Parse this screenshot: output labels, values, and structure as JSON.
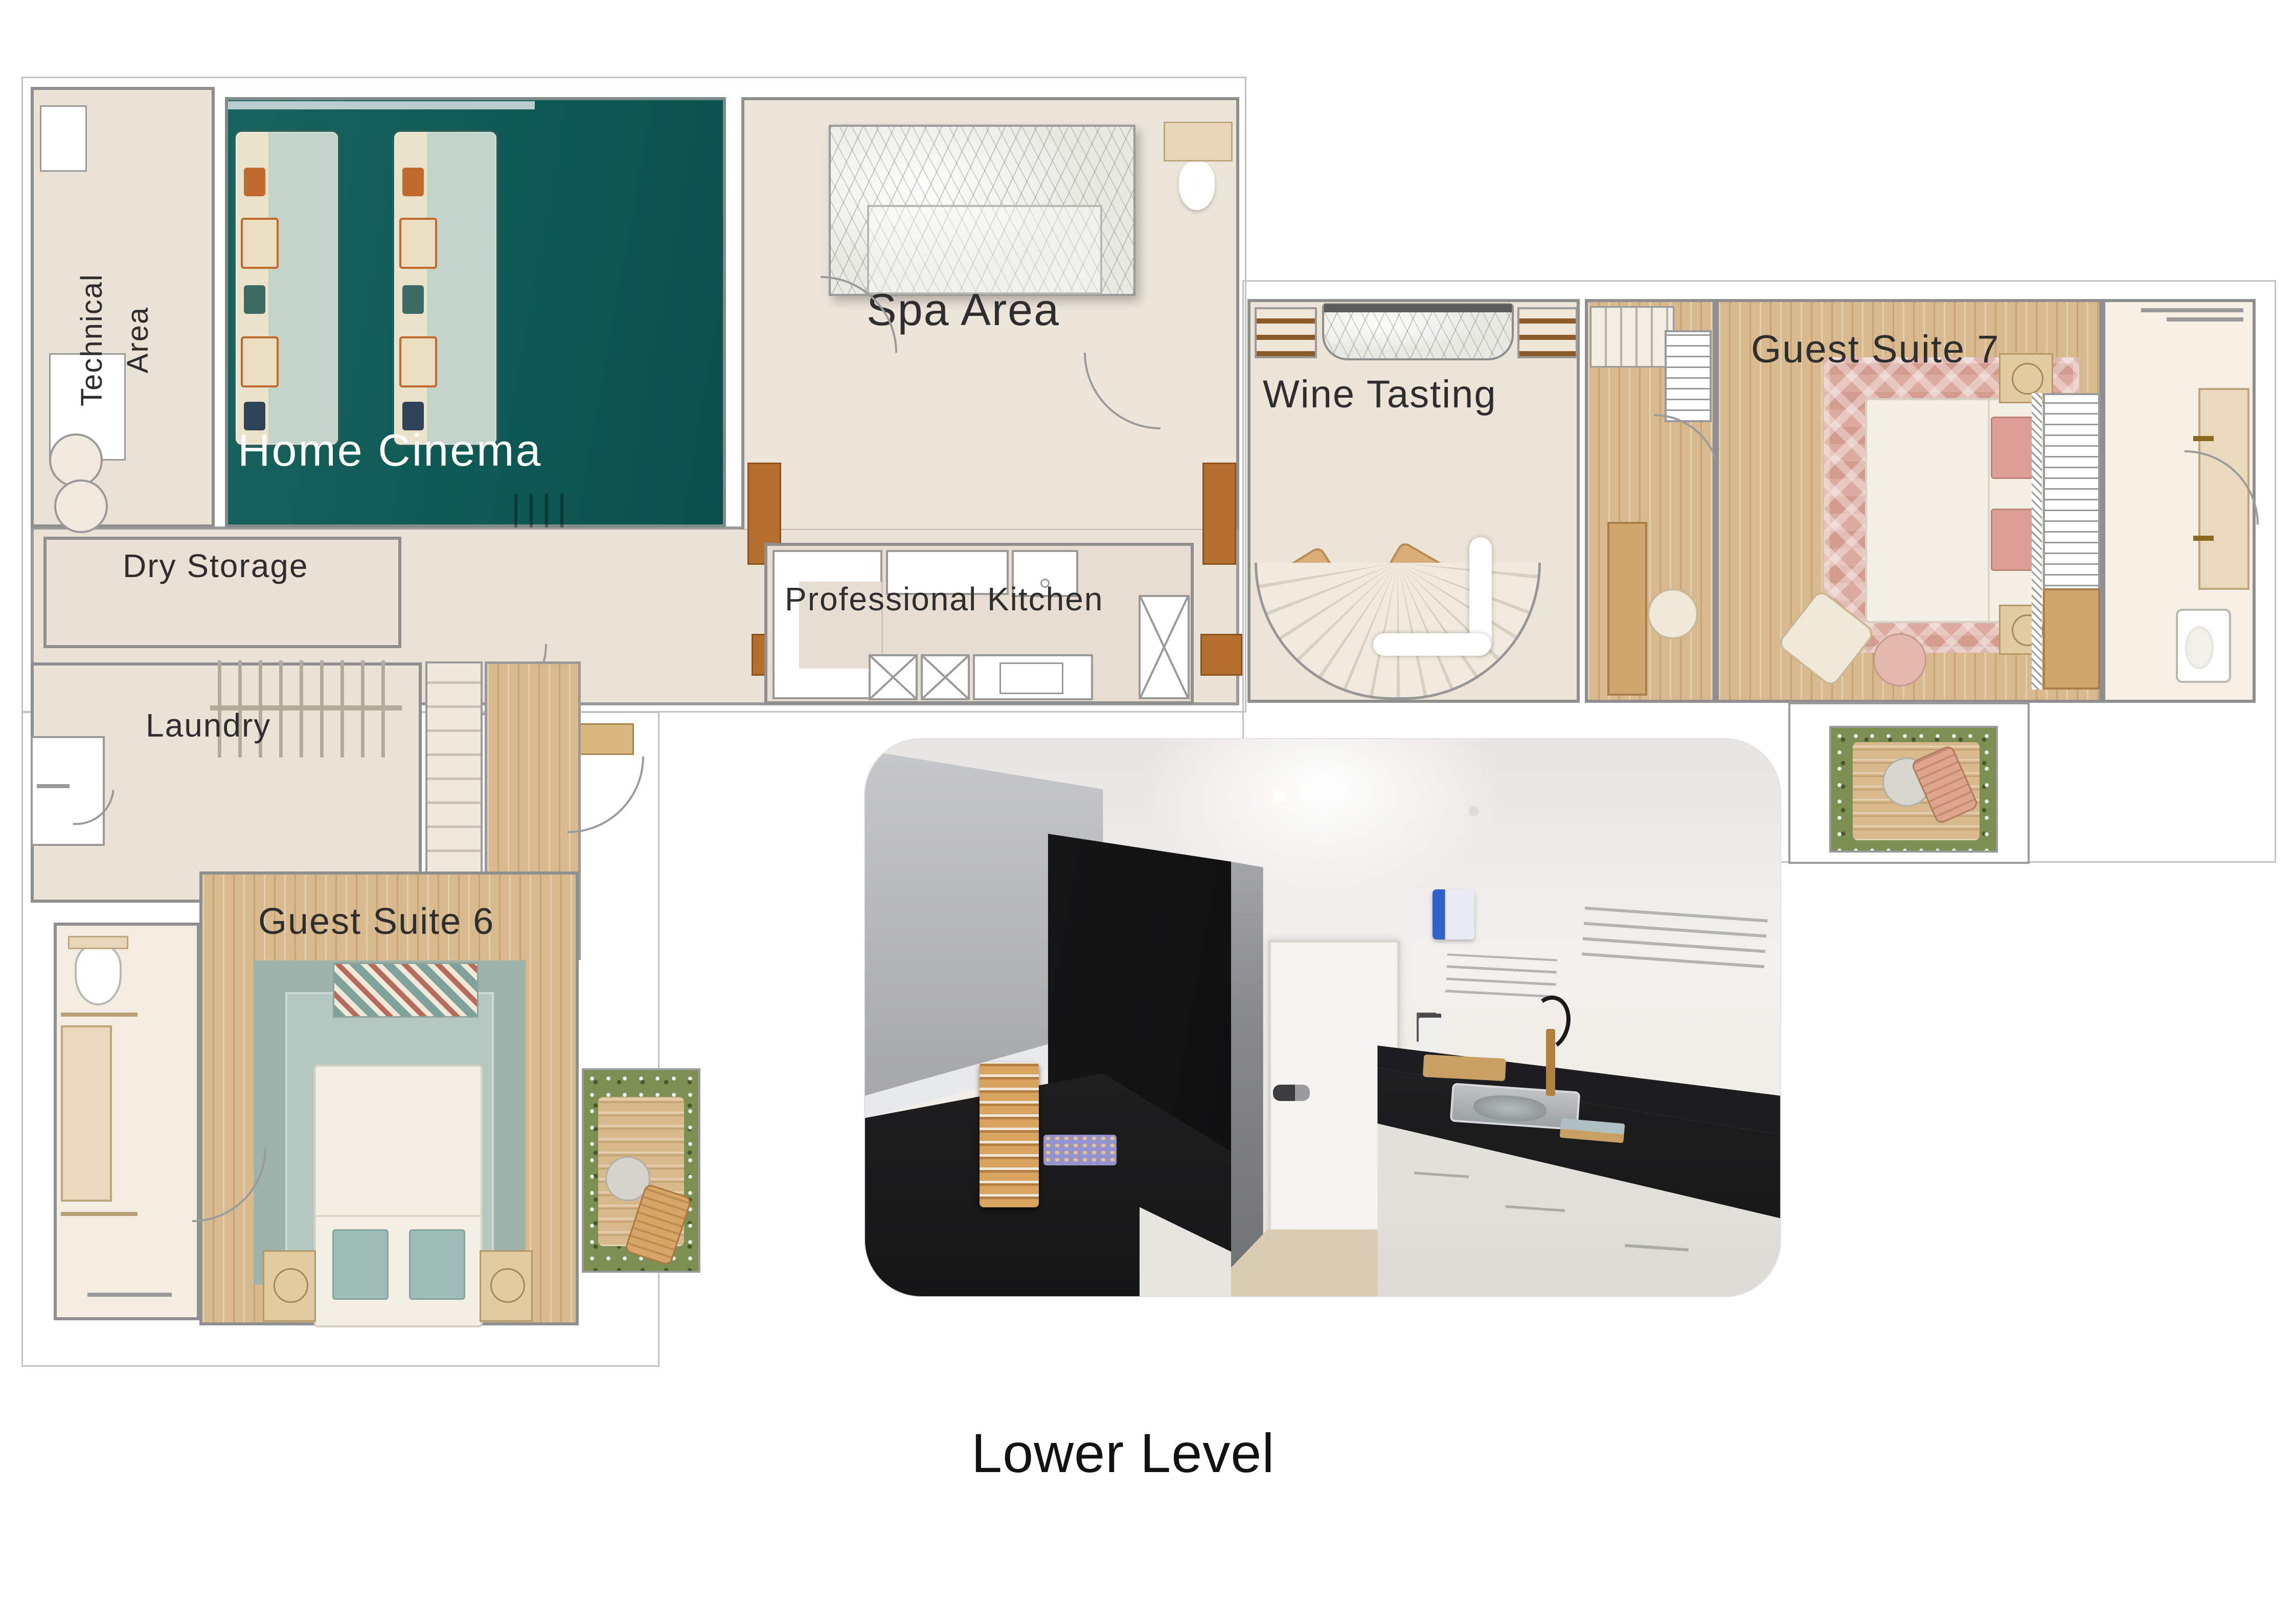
{
  "plan": {
    "caption": "Lower Level",
    "rooms": {
      "technical": {
        "line1": "Technical",
        "line2": "Area"
      },
      "home_cinema": {
        "label": "Home Cinema"
      },
      "spa": {
        "label": "Spa Area"
      },
      "wine": {
        "label": "Wine Tasting"
      },
      "guest7": {
        "label": "Guest Suite 7"
      },
      "dry_storage": {
        "label": "Dry Storage"
      },
      "kitchen": {
        "label": "Professional Kitchen"
      },
      "laundry": {
        "label": "Laundry"
      },
      "guest6": {
        "label": "Guest Suite 6"
      }
    },
    "colors": {
      "cinema_teal": "#11605a",
      "floor_beige": "#eae2d5",
      "wood": "#d8ba8e",
      "rug_pink": "#dcab9f",
      "rug_teal": "#a9beb7",
      "marble": "#e9e9e4",
      "label_ink": "#2e2e2e"
    }
  }
}
